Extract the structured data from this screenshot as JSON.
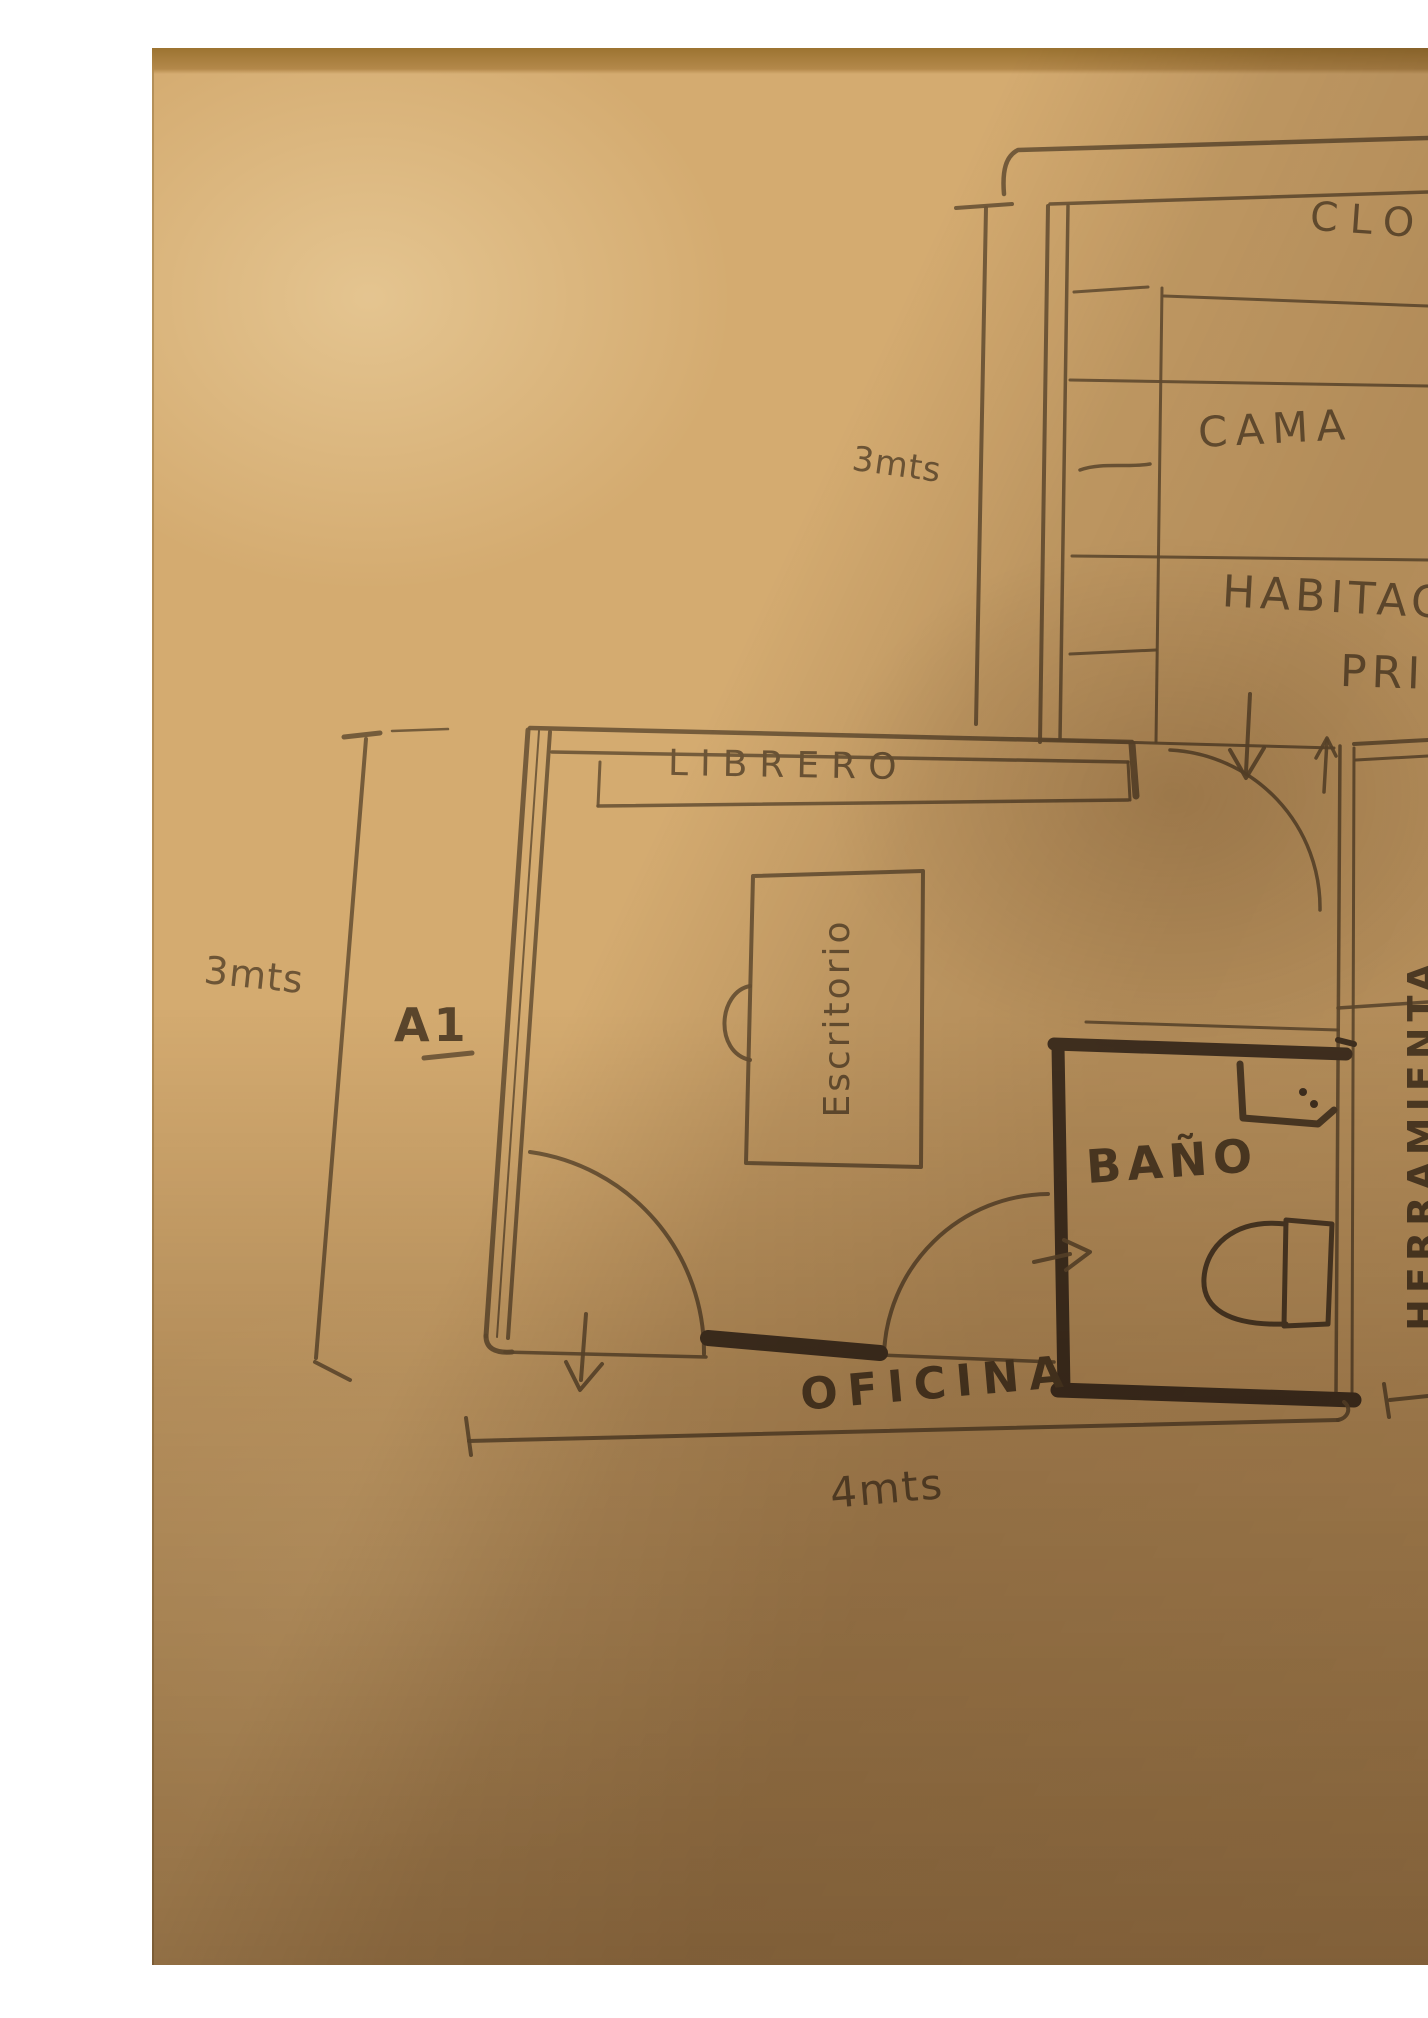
{
  "labels": {
    "closet": "CLOS",
    "cama": "CAMA",
    "habitacion_line1": "HABITAC",
    "habitacion_line2": "PRIN",
    "librero": "LIBRERO",
    "escritorio": "Escritorio",
    "bano": "BAÑO",
    "oficina": "OFICINA",
    "herramienta": "HERRAMIENTA",
    "unit_a1": "A1"
  },
  "dimensions": {
    "bedroom_depth": "3mts",
    "office_depth": "3mts",
    "office_width": "4mts"
  },
  "colors": {
    "paper": "#d4ab70",
    "paper_edge": "#9c7331",
    "pencil": "#6d5536",
    "pencil_dark": "#4a3826",
    "background": "#ffffff"
  }
}
